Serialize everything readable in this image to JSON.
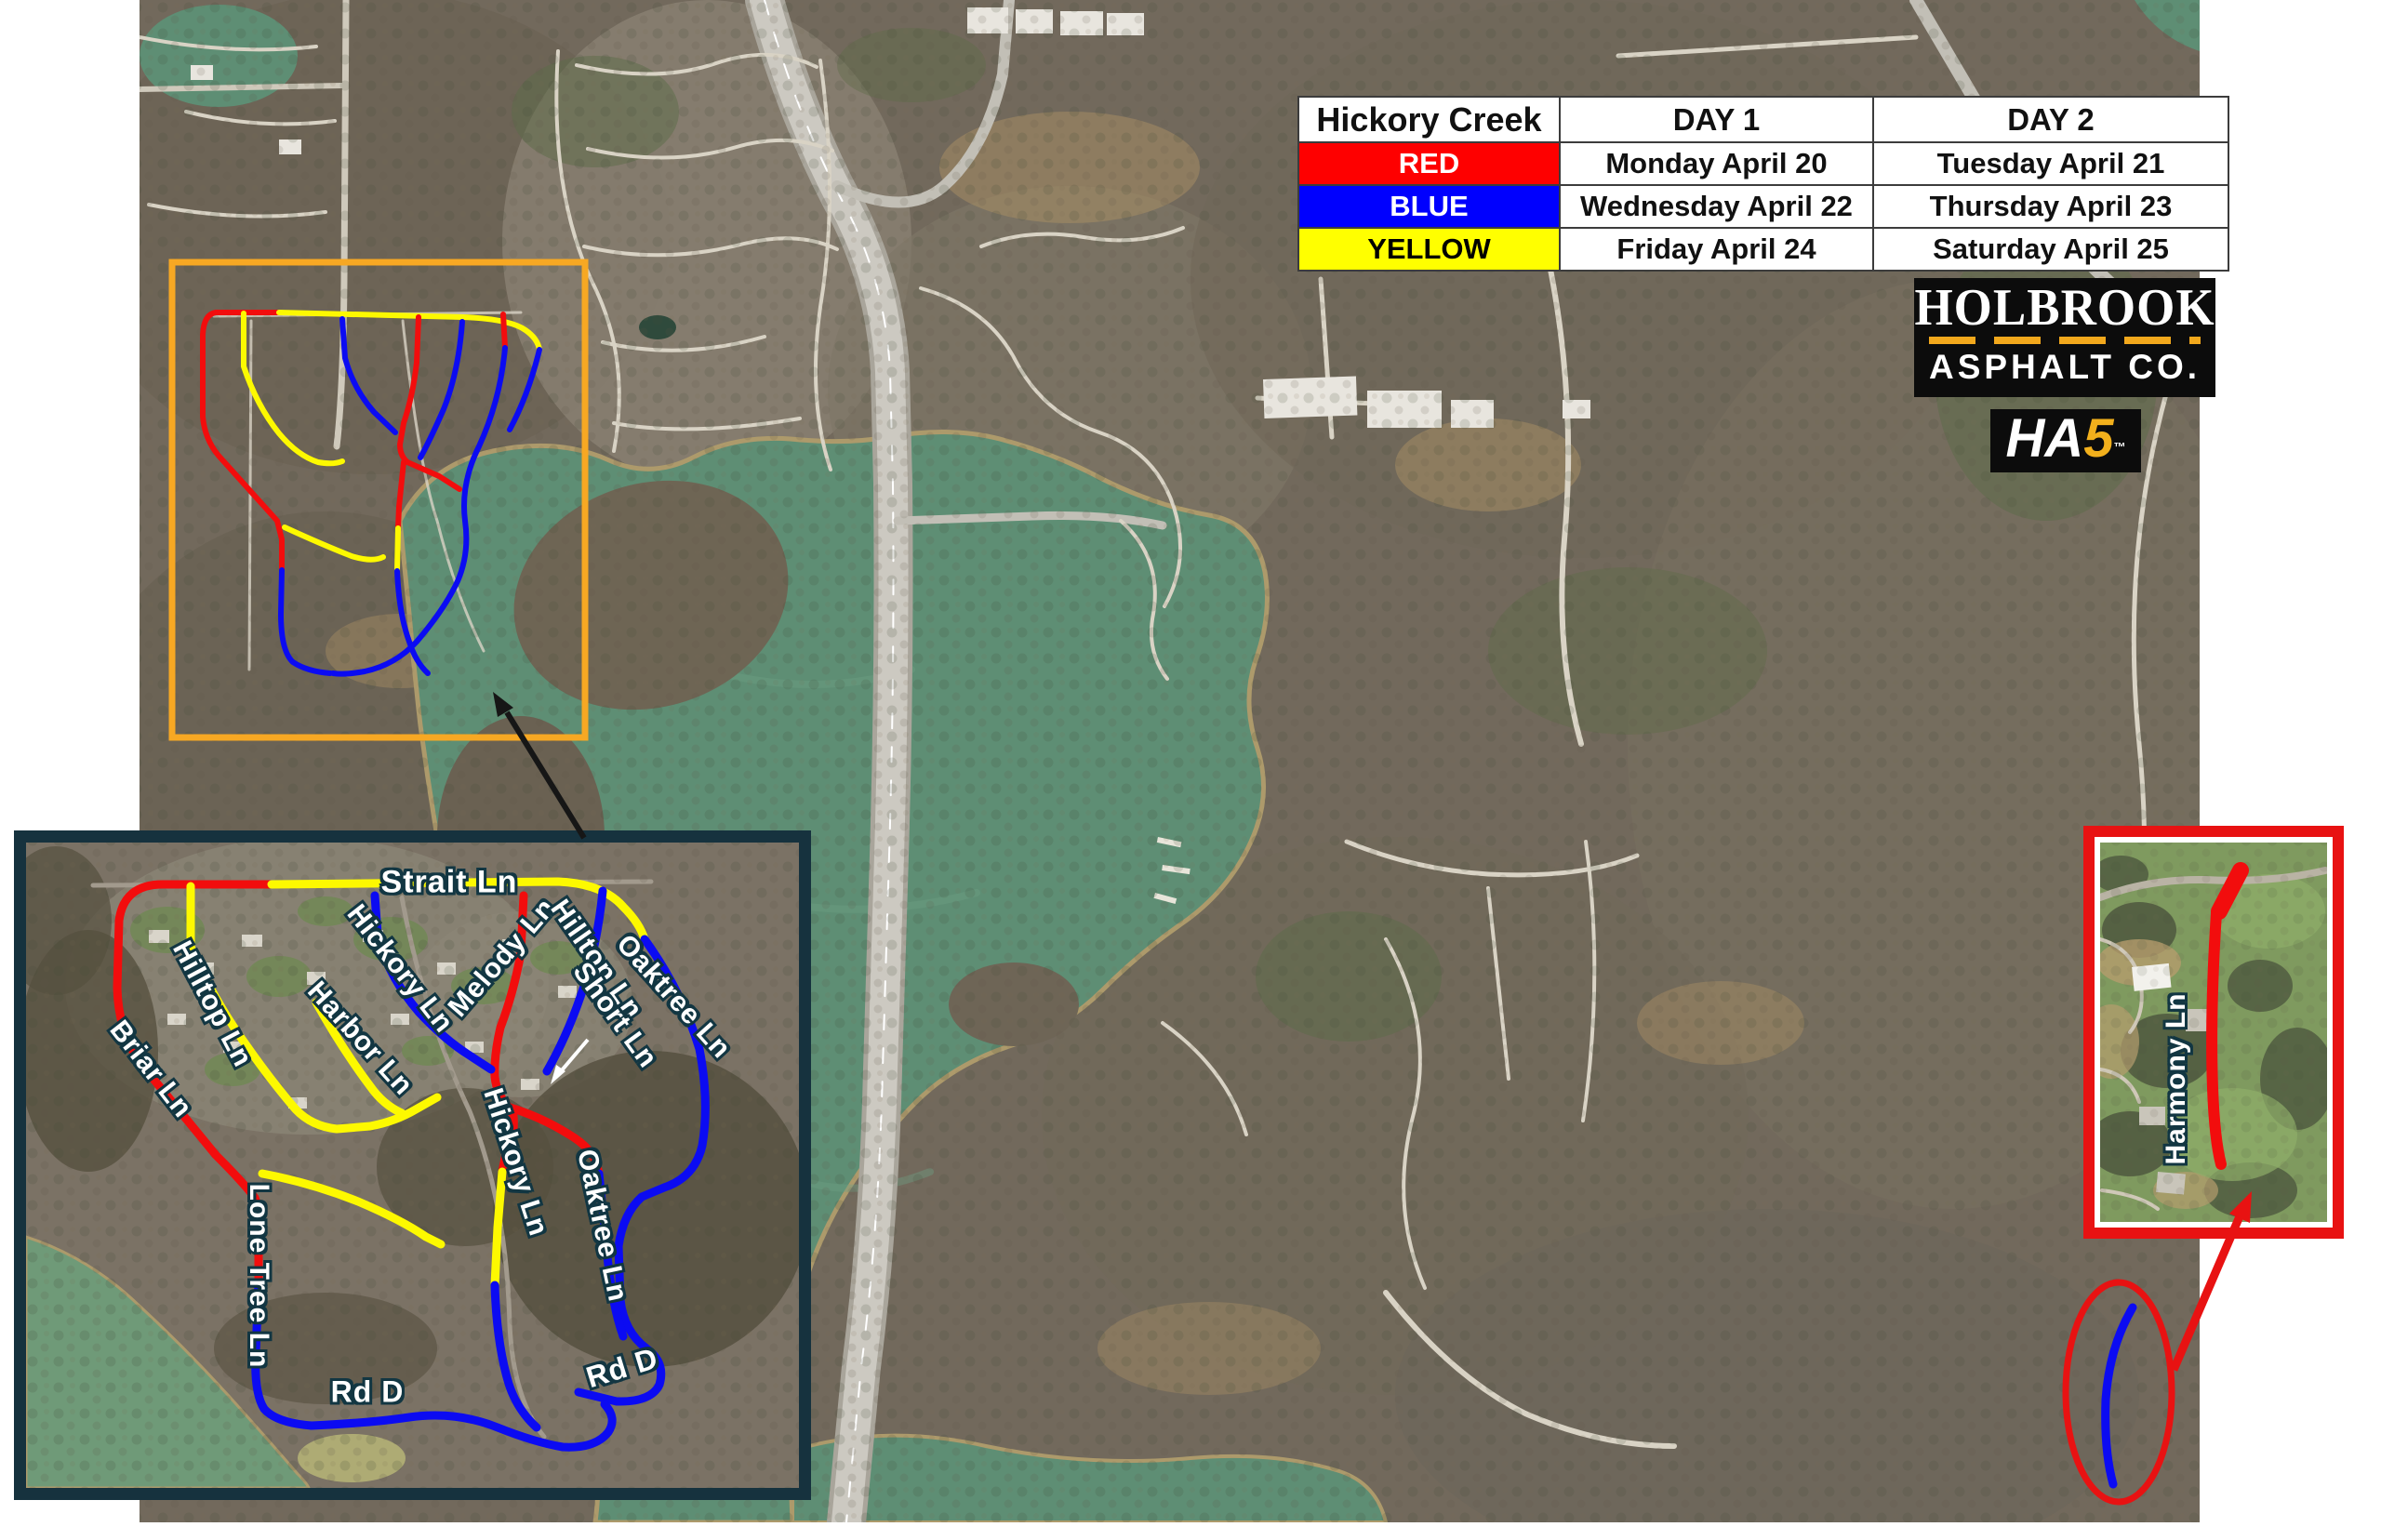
{
  "table": {
    "title": "Hickory Creek",
    "col1": "DAY 1",
    "col2": "DAY 2",
    "rows": [
      {
        "label": "RED",
        "bg": "#FE0000",
        "fg": "#FFFFFF",
        "day1": "Monday April 20",
        "day2": "Tuesday April 21"
      },
      {
        "label": "BLUE",
        "bg": "#0000FE",
        "fg": "#FFFFFF",
        "day1": "Wednesday April 22",
        "day2": "Thursday April 23"
      },
      {
        "label": "YELLOW",
        "bg": "#FFFF00",
        "fg": "#000000",
        "day1": "Friday April 24",
        "day2": "Saturday April 25"
      }
    ]
  },
  "logo": {
    "line1": "HOLBROOK",
    "line2": "ASPHALT CO.",
    "ha": "HA",
    "five": "5",
    "tm": "™"
  },
  "labels": {
    "strait": "Strait Ln",
    "hilltop_left": "Hilltop Ln",
    "briar": "Briar Ln",
    "harbor": "Harbor Ln",
    "hickory_upper": "Hickory Ln",
    "melody": "Melody Ln",
    "hilltop_right": "Hilltop Ln",
    "short_ln": "Short Ln",
    "oaktree_upper": "Oaktree Ln",
    "hickory_lower": "Hickory Ln",
    "oaktree_lower": "Oaktree Ln",
    "lone_tree": "Lone Tree Ln",
    "rd_d_left": "Rd D",
    "rd_d_right": "Rd D",
    "harmony": "Harmony Ln"
  },
  "colors": {
    "route_red": "#F20D0D",
    "route_blue": "#0B0BF2",
    "route_yellow": "#FDF900",
    "overview_box": "#F7A823",
    "detail_border": "#16323E",
    "callout_red": "#E81212",
    "table_red": "#FE0000",
    "table_blue": "#0000FE",
    "table_yellow": "#FFFF00"
  }
}
